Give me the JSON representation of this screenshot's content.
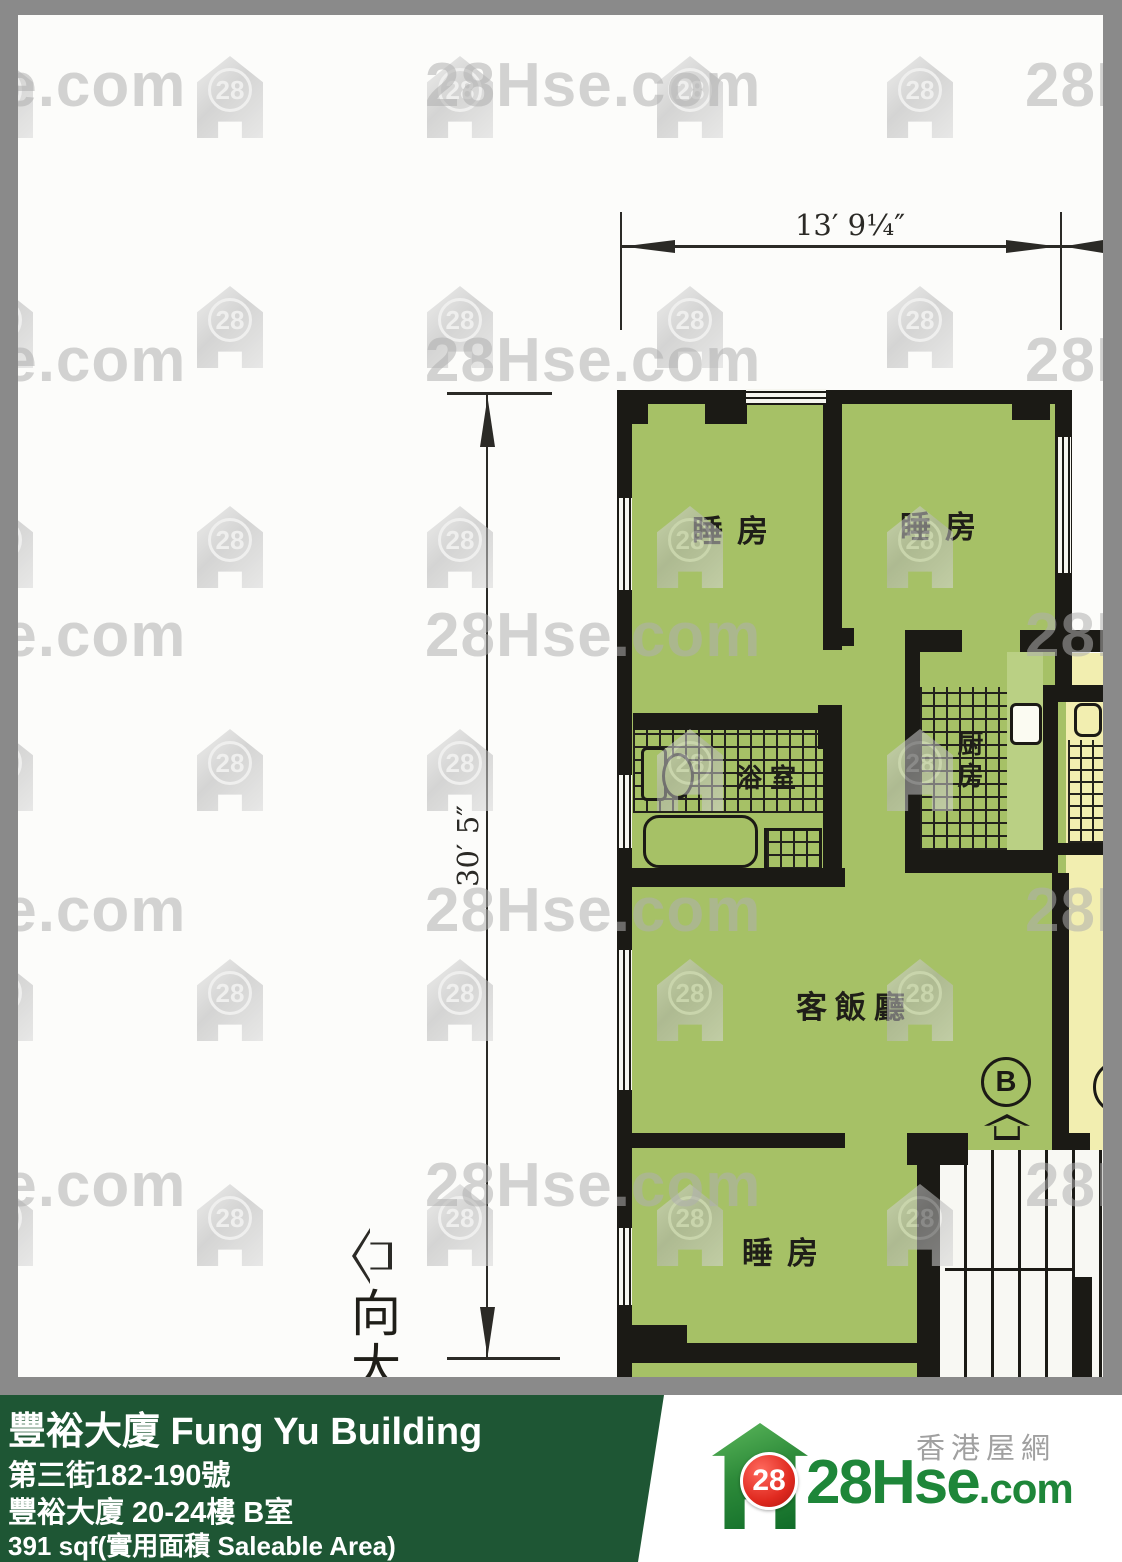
{
  "watermark": {
    "text": "28Hse.com",
    "badge": "28"
  },
  "plan": {
    "dimension_width": "13′ 9¼″",
    "dimension_height": "30′ 5″",
    "orientation_label": "向大",
    "unit_badge": "B",
    "rooms": {
      "bedroom_top_left": "睡房",
      "bedroom_top_right": "睡房",
      "bathroom": "浴室",
      "kitchen": "厨房",
      "living_dining": "客飯廳",
      "bedroom_bottom": "睡房"
    }
  },
  "footer": {
    "building_title": "豐裕大廈 Fung Yu Building",
    "address": "第三街182-190號",
    "unit_info": "豐裕大廈 20-24樓 B室",
    "area_info": "391 sqf(實用面積 Saleable Area)"
  },
  "logo": {
    "badge": "28",
    "brand": "28Hse",
    "suffix": ".com",
    "tagline": "香港屋網"
  },
  "colors": {
    "plan_green": "#a6c166",
    "neighbor_yellow": "#f2eeb0",
    "wall_black": "#1b1a15",
    "frame_gray": "#8a8a8a",
    "footer_green": "#1e5634",
    "logo_red": "#d6231f",
    "logo_green": "#1e8639"
  }
}
